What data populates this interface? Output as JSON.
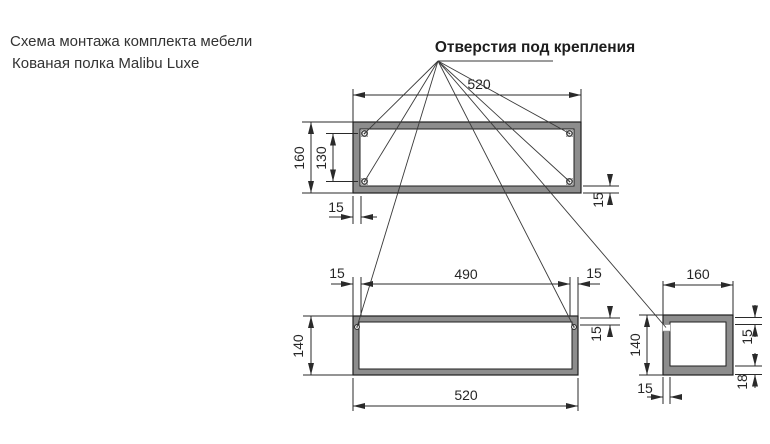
{
  "header": {
    "line1": "Схема монтажа комплекта мебели",
    "line2": "Кованая полка Malibu Luxe"
  },
  "callout": {
    "title": "Отверстия под крепления"
  },
  "colors": {
    "line": "#2a2a2a",
    "frame_fill": "#8d8d8d",
    "text": "#262626",
    "background": "#ffffff"
  },
  "dimensions": {
    "top_view": {
      "width": "520",
      "height": "160",
      "hole_spacing": "130",
      "hole_edge_offset": "15",
      "profile_thickness": "15"
    },
    "front_view": {
      "width": "520",
      "hole_span": "490",
      "left_hole_offset": "15",
      "right_hole_offset": "15",
      "height": "140",
      "profile_thickness": "15"
    },
    "side_view": {
      "width": "160",
      "height": "140",
      "top_profile_thickness": "15",
      "bottom_profile_thickness": "18",
      "hole_edge_offset": "15"
    }
  }
}
